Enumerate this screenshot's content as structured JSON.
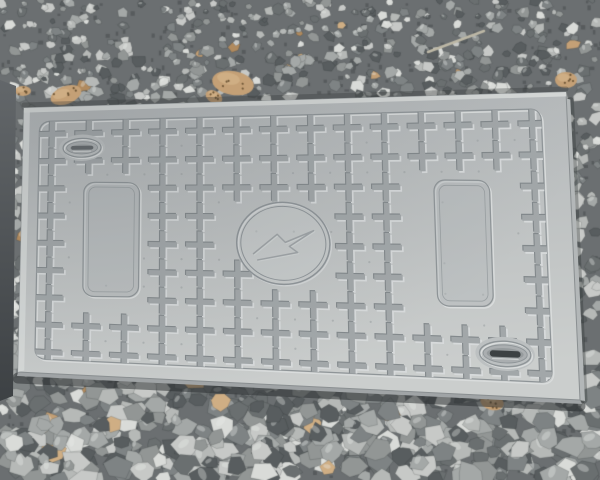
{
  "scene": {
    "description": "Photograph of a grey composite electric utility cover plate with embossed cross studs lying on crushed gravel",
    "canvas": {
      "width": 600,
      "height": 480
    }
  },
  "gravel": {
    "seed": 11,
    "count": 2300,
    "base_color": "#6b6f71",
    "palette": [
      "#c7c9c7",
      "#b6b9b7",
      "#a4a8a7",
      "#929695",
      "#7e8384",
      "#6a6f70",
      "#585d5f"
    ],
    "highlight": "#d9dbd8",
    "tan": [
      "#c4a076",
      "#b08a5e",
      "#cfae84"
    ],
    "crevice": "#43484a",
    "stone_min": 4.5,
    "stone_max": 10.5
  },
  "leaves": [
    {
      "x": 66,
      "y": 95,
      "rx": 16,
      "ry": 9,
      "rot": -20
    },
    {
      "x": 233,
      "y": 83,
      "rx": 21,
      "ry": 12,
      "rot": 10
    },
    {
      "x": 23,
      "y": 91,
      "rx": 8,
      "ry": 5,
      "rot": 0
    },
    {
      "x": 214,
      "y": 97,
      "rx": 9,
      "ry": 6,
      "rot": 30
    },
    {
      "x": 566,
      "y": 80,
      "rx": 11,
      "ry": 8,
      "rot": 0
    },
    {
      "x": 492,
      "y": 402,
      "rx": 12,
      "ry": 8,
      "rot": 15
    }
  ],
  "twig": {
    "x1": 428,
    "y1": 52,
    "x2": 484,
    "y2": 31,
    "color": "#bdb8a6",
    "width": 2.5
  },
  "dark_strip": {
    "points": [
      [
        0,
        80
      ],
      [
        16,
        86
      ],
      [
        13,
        396
      ],
      [
        0,
        401
      ]
    ],
    "top_color": "#63676a",
    "bottom_color": "#3d4144"
  },
  "plate": {
    "corners": {
      "tl": [
        24,
        108
      ],
      "tr": [
        566,
        92
      ],
      "br": [
        580,
        400
      ],
      "bl": [
        18,
        372
      ]
    },
    "local": {
      "w": 545,
      "h": 285
    },
    "surface": {
      "top": "#b1b5b7",
      "bottom": "#cbcecd",
      "bevel": "#d7dad9",
      "side": "#b3b7b8",
      "under": "#a0a4a6",
      "edge": "#8a8f91"
    },
    "frame": {
      "x": 16,
      "y": 15,
      "w": 503,
      "h": 255,
      "r": 10,
      "dark": "#8f9598",
      "light": "#d9dcdc"
    },
    "studs": {
      "cols": 14,
      "rows": 9,
      "x0": 29,
      "y0": 29,
      "dx": 37,
      "dy": 29.2,
      "arm": 14,
      "thick": 2.7,
      "fill": "#a2a7a9",
      "dark": "#83898c",
      "light": "#d7dadb",
      "dot_color": "#9aa0a2",
      "dot_ratio": 0.35
    },
    "panels": [
      {
        "name": "left-blank-panel",
        "cx": 89,
        "cy": 141,
        "w": 55,
        "h": 120,
        "r": 11
      },
      {
        "name": "right-blank-panel",
        "cx": 437,
        "cy": 141,
        "w": 55,
        "h": 120,
        "r": 11
      }
    ],
    "emblem": {
      "name": "electric-lightning-emblem",
      "cx": 259,
      "cy": 143,
      "rx": 46,
      "ry": 41,
      "ring_gap": 4,
      "stroke": "#8f9599",
      "light": "#d2d5d6",
      "bolt": [
        [
          -30,
          11
        ],
        [
          -6,
          -9
        ],
        [
          2,
          -1
        ],
        [
          30,
          -13
        ],
        [
          6,
          3
        ],
        [
          14,
          9
        ],
        [
          -26,
          17
        ]
      ]
    },
    "handles": [
      {
        "name": "lift-slot-top-left",
        "cx": 59,
        "cy": 44,
        "rx": 19,
        "ry": 10,
        "slot_w": 22,
        "slot_h": 4,
        "slot_color": "#62676a"
      },
      {
        "name": "lift-slot-bottom-right",
        "cx": 474,
        "cy": 245,
        "rx": 25,
        "ry": 12,
        "slot_w": 30,
        "slot_h": 6,
        "slot_color": "#3c4143"
      }
    ]
  }
}
